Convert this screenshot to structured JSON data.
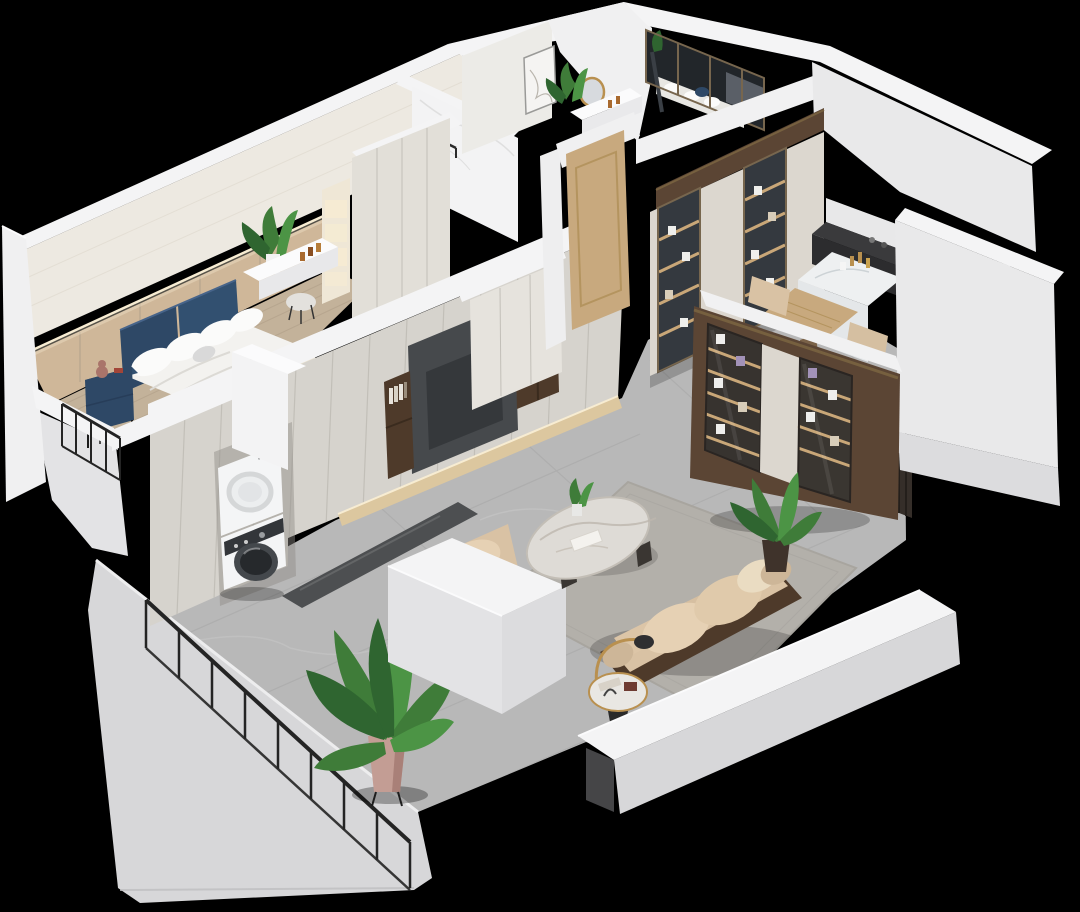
{
  "meta": {
    "description": "Photorealistic 3D isometric dollhouse cutaway render of a small apartment on a black background",
    "canvas": {
      "width": 1080,
      "height": 912
    },
    "background": "#000000"
  },
  "palette": {
    "black": "#000000",
    "wallTop": "#f4f4f5",
    "wallBright": "#fbfbfc",
    "wallFace": "#e9e9ea",
    "wallFaceDim": "#dcdcde",
    "wallCream": "#ede9e1",
    "wallShade": "#e3e3e5",
    "panelGray": "#d6d3cd",
    "panelSeam": "#c2bfb8",
    "creamCab": "#dcd7cf",
    "woodFloor": "#c3b29a",
    "woodWall": "#cfb799",
    "plankSeam": "#b2a18a",
    "oakDoor": "#c8a97e",
    "oakDark": "#b4945f",
    "walnut": "#5b4534",
    "walnutDark": "#4e3a2a",
    "walnutDeep": "#3a2b1e",
    "bronzeFrame": "#77664e",
    "navy": "#2e4866",
    "navyLight": "#325070",
    "navyDeep": "#273d59",
    "bedding": "#f3f2ef",
    "pillow": "#fbfbfa",
    "bedBase": "#ece4d2",
    "marbleFloor": "#b8b8b8",
    "marbleSeam": "#a6a6a6",
    "marbleVein": "#cfcfcf",
    "marbleWhite": "#f3f3f4",
    "marbleVein2": "#d9d9d9",
    "rug": "#b3b0aa",
    "rugEdge": "#a8a59f",
    "beige": "#d9c2a4",
    "beigeLight": "#e6d1b4",
    "beigePale": "#eadcc2",
    "counterDark": "#3a3a3c",
    "counterFront": "#2c2c2e",
    "glassDark": "#34393f",
    "glassCab": "#37332f",
    "glassShelf": "#c9a778",
    "tvRecess": "#46494c",
    "tvScreen": "#35383b",
    "ledWarm": "#dcc79f",
    "ledGlow": "#f7ecd2",
    "green": "#3f7c39",
    "greenDark": "#2f6530",
    "greenLight": "#4c9445",
    "potPink": "#c39d94",
    "potShade": "#a98078",
    "gold": "#b9904f",
    "amber": "#a96a2f",
    "lavender": "#a292b8",
    "railing": "#242424",
    "threshold": "#4d4f51",
    "plinth": "#d7d7d9",
    "plinthEdge": "#ededee",
    "applianceWhite": "#f4f5f6",
    "applianceShade": "#dfe1e3",
    "slatDark": "#352e29",
    "shadow": "#000000",
    "gray": "#8d8a84",
    "mirrorGlass": "#d7dade",
    "teddy": "#a9746a",
    "redBook": "#a24538"
  },
  "scene": {
    "title": "apartment-dollhouse-cutaway",
    "rooms": [
      {
        "id": "master-bedroom",
        "label": "Master bedroom",
        "items": [
          "navy upholstered bed",
          "white bedding and pillows",
          "navy nightstand with teddy bear",
          "floating vanity shelf",
          "perfume bottles",
          "vanity stool",
          "potted plant",
          "backlit wood accent wall",
          "paneled wardrobe",
          "juliet balcony railing"
        ]
      },
      {
        "id": "bathroom",
        "label": "Bathroom",
        "items": [
          "white marble walls",
          "black towel bar"
        ]
      },
      {
        "id": "hallway",
        "label": "Hallway",
        "items": [
          "line-art picture",
          "round gold mirror",
          "white console shelf",
          "green plant",
          "small bottles"
        ]
      },
      {
        "id": "second-bedroom",
        "label": "Second bedroom",
        "items": [
          "dark glass partition",
          "bed with white and navy pillows",
          "gray headboard",
          "open shelving"
        ]
      },
      {
        "id": "entry",
        "label": "Entry",
        "items": [
          "light oak entry door",
          "white shoe cabinet",
          "walnut header beam",
          "backlit glass display cabinets"
        ]
      },
      {
        "id": "kitchen-dining",
        "label": "Kitchen / dining",
        "items": [
          "dark stone counter",
          "white marble island",
          "gold bottles",
          "wood dining table",
          "two beige chairs",
          "dark slatted panel"
        ]
      },
      {
        "id": "living-room",
        "label": "Living room",
        "items": [
          "paneled TV wall with recess",
          "walnut book shelves",
          "LED floor wash",
          "beige fabric sofa with walnut frame",
          "beige lounge chair",
          "oval marble coffee table",
          "round side table with arc lamp",
          "gray area rug",
          "bird of paradise plant",
          "walnut glass display bookcase"
        ]
      },
      {
        "id": "balcony-laundry",
        "label": "Balcony / laundry",
        "items": [
          "stacked dryer and washer",
          "black metal railing",
          "potted bird of paradise plant",
          "gray stone floor",
          "dark stone threshold"
        ]
      }
    ],
    "structure": [
      "white cut wall tops",
      "light gray building plinth",
      "black void background"
    ]
  }
}
